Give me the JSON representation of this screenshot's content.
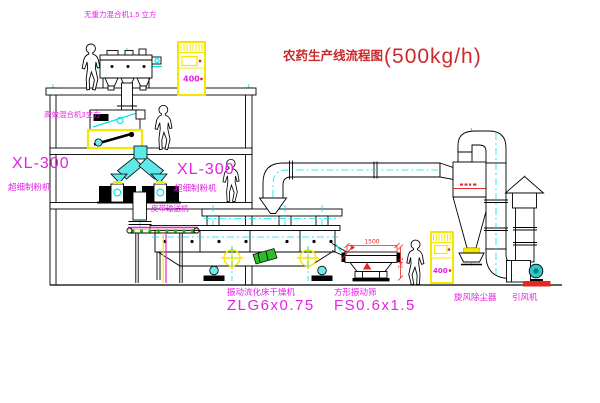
{
  "title": {
    "text_zh": "农药生产线流程图",
    "capacity": "(500kg/h)"
  },
  "equipment_labels": {
    "gravity_free_mixer": "无重力混合机1.5 立方",
    "high_efficiency_mixer": "高效混合机3立方",
    "mill_left": {
      "model": "XL-300",
      "name": "超细制粉机"
    },
    "mill_right": {
      "model": "XL-300",
      "name": "超细制粉机"
    },
    "belt_conveyor": "皮带输送机",
    "fluid_bed_dryer": {
      "name": "振动流化床干燥机",
      "model": "ZLG6x0.75"
    },
    "vibrating_screen": {
      "name": "方形振动筛",
      "model": "FS0.6x1.5"
    },
    "cyclone_dust_collector": "旋风除尘器",
    "induced_draft_fan": "引风机"
  },
  "dimensions": {
    "screen_width": "1500",
    "screen_height": "741"
  },
  "control_cabinets": {
    "panel_text": "400"
  },
  "colors": {
    "label_magenta": "#e520e5",
    "title_red": "#cc2a2a",
    "dimension_red": "#e8251f",
    "pipe_cyan": "#00e5e5",
    "cabinet_yellow": "#f5e800",
    "highlight_green": "#2abf2a",
    "line_black": "#000000",
    "background": "#ffffff"
  }
}
